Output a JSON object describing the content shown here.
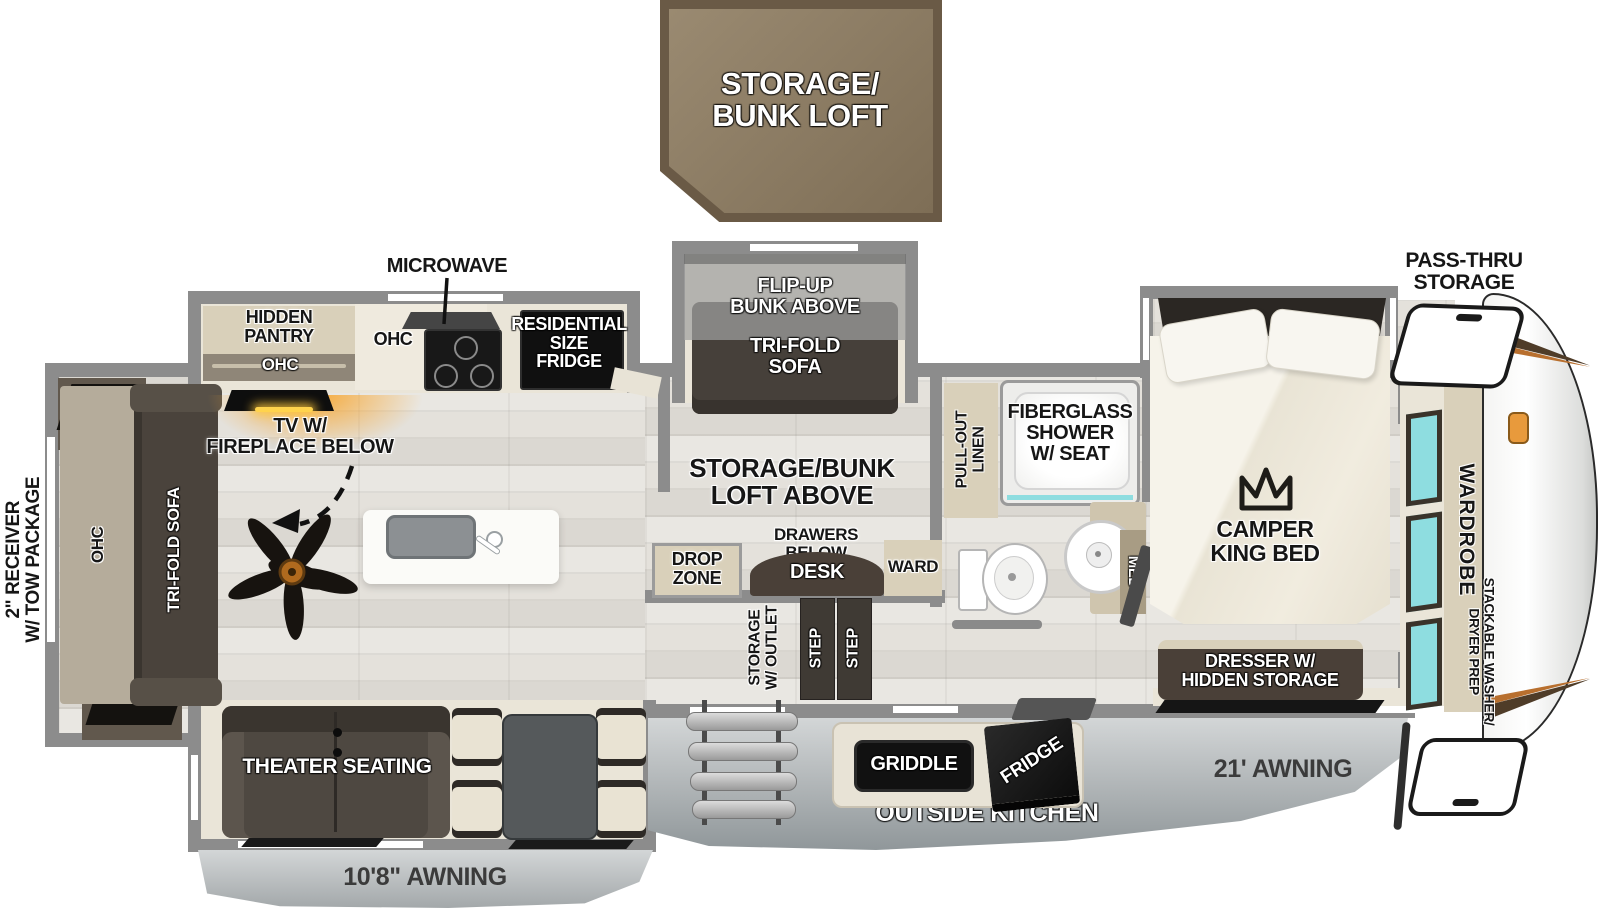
{
  "title": "Fifth wheel RV floor plan",
  "labels": {
    "loft_box": "STORAGE/\nBUNK LOFT",
    "microwave": "MICROWAVE",
    "hidden_pantry": "HIDDEN\nPANTRY",
    "pantry_ohc": "OHC",
    "counter_ohc": "OHC",
    "residential_fridge": "RESIDENTIAL\nSIZE\nFRIDGE",
    "flip_up_bunk": "FLIP-UP\nBUNK ABOVE",
    "bunk_sofa": "TRI-FOLD\nSOFA",
    "pass_thru": "PASS-THRU\nSTORAGE",
    "pull_out_linen": "PULL-OUT\nLINEN",
    "shower": "FIBERGLASS\nSHOWER\nW/ SEAT",
    "med": "MED",
    "king_bed": "CAMPER\nKING BED",
    "tv_fireplace": "TV W/\nFIREPLACE BELOW",
    "loft_above": "STORAGE/BUNK\nLOFT ABOVE",
    "drawers_below": "DRAWERS\nBELOW",
    "desk": "DESK",
    "ward": "WARD",
    "drop_zone": "DROP\nZONE",
    "receiver": "2\" RECEIVER\nW/ TOW PACKAGE",
    "sofa_ohc": "OHC",
    "rear_sofa": "TRI-FOLD SOFA",
    "storage_outlet": "STORAGE\nW/ OUTLET",
    "step_1": "STEP",
    "step_2": "STEP",
    "wardrobe": "WARDROBE",
    "washer_prep": "STACKABLE WASHER/\nDRYER PREP",
    "dresser": "DRESSER W/\nHIDDEN STORAGE",
    "theater": "THEATER SEATING",
    "awning_rear": "10'8\" AWNING",
    "awning_main": "21' AWNING",
    "outside_kitchen": "OUTSIDE KITCHEN",
    "griddle": "GRIDDLE",
    "outside_fridge": "FRIDGE"
  },
  "colors": {
    "wall_gray": "#8c8c8c",
    "loft_brown": "#8d7c64",
    "loft_border": "#6a5a46",
    "cabinet_tan": "#d9d0ba",
    "furniture_dark": "#48423b",
    "window_teal": "#8edde0",
    "accent_orange": "#e99c3f",
    "awning_gray": "#a8adaf",
    "fireplace_glow": "#f7a630"
  }
}
